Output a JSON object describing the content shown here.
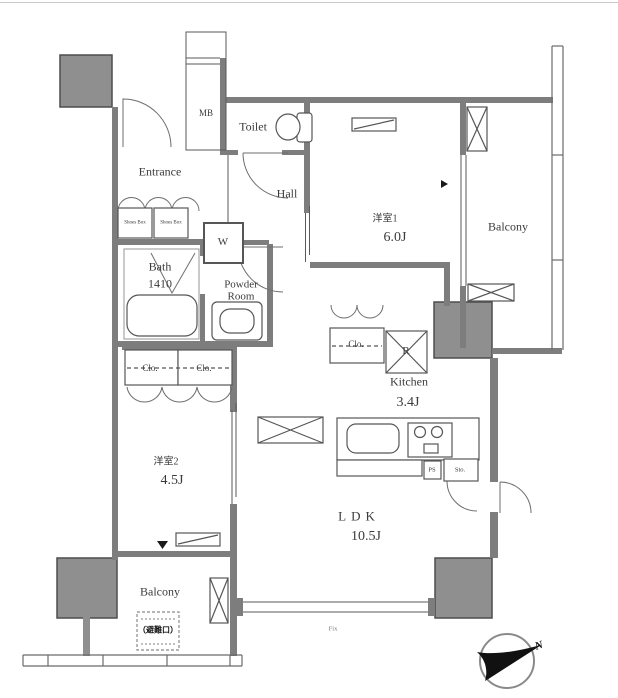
{
  "labels": {
    "entrance": "Entrance",
    "hall": "Hall",
    "toilet": "Toilet",
    "mb": "MB",
    "bath_name": "Bath",
    "bath_size": "1410",
    "powder_room": "Powder Room",
    "washer": "W",
    "shoes_box_left": "Shoes Box",
    "shoes_box_right": "Shoes Box",
    "western1_name": "洋室1",
    "western1_size": "6.0J",
    "western2_name": "洋室2",
    "western2_size": "4.5J",
    "kitchen_name": "Kitchen",
    "kitchen_size": "3.4J",
    "ldk_name": "LDK",
    "ldk_size": "10.5J",
    "balcony_top": "Balcony",
    "balcony_bottom": "Balcony",
    "closet_w2_left": "Clo.",
    "closet_w2_right": "Clo.",
    "closet_w1": "Clo.",
    "refrigerator": "R",
    "pipe_space": "PS",
    "storage": "Sto.",
    "fix_window": "Fix",
    "escape_hatch": "（避難口）",
    "compass_north": "N"
  },
  "colors": {
    "background": "#ffffff",
    "wall": "#7d7d7d",
    "column": "#8f8f8f",
    "line": "#565656",
    "text": "#3b3b3b"
  }
}
